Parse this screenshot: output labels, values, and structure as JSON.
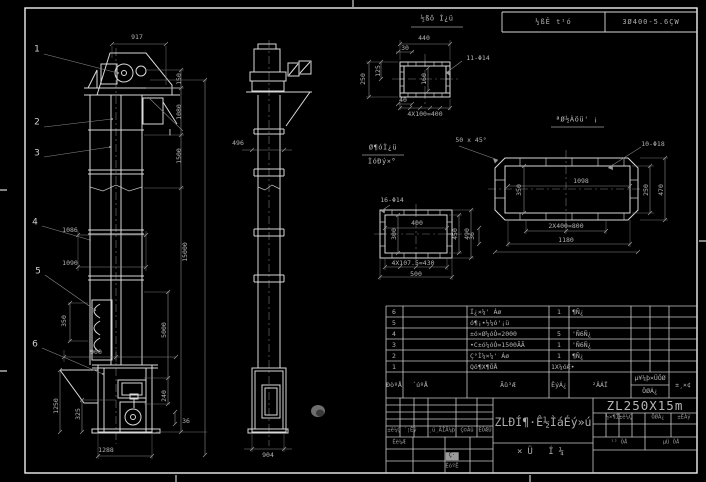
{
  "sheet": {
    "header_strip": {
      "left": "½ßÊ t¹ó",
      "right": "3Ø400-5.6ÇW"
    }
  },
  "annotations": [
    {
      "t": "917",
      "x": 137,
      "y": 37
    },
    {
      "t": "150",
      "x": 179,
      "y": 79,
      "r": 1
    },
    {
      "t": "1080",
      "x": 179,
      "y": 112,
      "r": 1
    },
    {
      "t": "1500",
      "x": 179,
      "y": 156,
      "r": 1
    },
    {
      "t": "15000",
      "x": 185,
      "y": 252,
      "r": 1
    },
    {
      "t": "1086",
      "x": 70,
      "y": 230
    },
    {
      "t": "1090",
      "x": 70,
      "y": 263
    },
    {
      "t": "350",
      "x": 64,
      "y": 321,
      "r": 1
    },
    {
      "t": "900",
      "x": 96,
      "y": 352
    },
    {
      "t": "5000",
      "x": 164,
      "y": 330,
      "r": 1
    },
    {
      "t": "240",
      "x": 164,
      "y": 396,
      "r": 1
    },
    {
      "t": "36",
      "x": 186,
      "y": 421
    },
    {
      "t": "1250",
      "x": 56,
      "y": 406,
      "r": 1
    },
    {
      "t": "325",
      "x": 78,
      "y": 414,
      "r": 1
    },
    {
      "t": "1288",
      "x": 106,
      "y": 450
    },
    {
      "t": "904",
      "x": 268,
      "y": 455
    },
    {
      "t": "496",
      "x": 238,
      "y": 143
    },
    {
      "t": "1",
      "x": 37,
      "y": 50,
      "c": "balloon"
    },
    {
      "t": "2",
      "x": 37,
      "y": 123,
      "c": "balloon"
    },
    {
      "t": "3",
      "x": 37,
      "y": 154,
      "c": "balloon"
    },
    {
      "t": "4",
      "x": 35,
      "y": 223,
      "c": "balloon"
    },
    {
      "t": "5",
      "x": 38,
      "y": 272,
      "c": "balloon"
    },
    {
      "t": "6",
      "x": 35,
      "y": 345,
      "c": "balloon"
    },
    {
      "t": "I",
      "x": 170,
      "y": 134,
      "c": "balloon"
    },
    {
      "t": "½ßô Ì¿ü",
      "x": 437,
      "y": 19,
      "c": "vt"
    },
    {
      "t": "440",
      "x": 424,
      "y": 38
    },
    {
      "t": "30",
      "x": 405,
      "y": 48
    },
    {
      "t": "250",
      "x": 363,
      "y": 79,
      "r": 1
    },
    {
      "t": "125",
      "x": 378,
      "y": 71,
      "r": 1
    },
    {
      "t": "160",
      "x": 424,
      "y": 79,
      "r": 1
    },
    {
      "t": "11-Φ14",
      "x": 478,
      "y": 58
    },
    {
      "t": "40",
      "x": 403,
      "y": 100
    },
    {
      "t": "4X100=400",
      "x": 425,
      "y": 114
    },
    {
      "t": "Ø¶óÌ¿ü",
      "x": 383,
      "y": 148,
      "c": "vt"
    },
    {
      "t": "ÌóÐý×°",
      "x": 382,
      "y": 162,
      "c": "vt"
    },
    {
      "t": "50 x 45°",
      "x": 471,
      "y": 140
    },
    {
      "t": "ªØ½Àöü' ¡",
      "x": 577,
      "y": 120,
      "c": "vt"
    },
    {
      "t": "10-Φ18",
      "x": 653,
      "y": 144
    },
    {
      "t": "1098",
      "x": 581,
      "y": 181
    },
    {
      "t": "350",
      "x": 519,
      "y": 190,
      "r": 1
    },
    {
      "t": "250",
      "x": 646,
      "y": 190,
      "r": 1
    },
    {
      "t": "470",
      "x": 661,
      "y": 190,
      "r": 1
    },
    {
      "t": "36",
      "x": 472,
      "y": 236,
      "r": 1
    },
    {
      "t": "2X400=800",
      "x": 566,
      "y": 226
    },
    {
      "t": "1180",
      "x": 566,
      "y": 240
    },
    {
      "t": "16-Φ14",
      "x": 392,
      "y": 200
    },
    {
      "t": "400",
      "x": 417,
      "y": 223
    },
    {
      "t": "300",
      "x": 394,
      "y": 234,
      "r": 1
    },
    {
      "t": "450",
      "x": 455,
      "y": 234,
      "r": 1
    },
    {
      "t": "490",
      "x": 467,
      "y": 234,
      "r": 1
    },
    {
      "t": "4X107.5=430",
      "x": 413,
      "y": 263
    },
    {
      "t": "500",
      "x": 416,
      "y": 274
    },
    {
      "t": "±ê¼Ç",
      "x": 394,
      "y": 431,
      "c": "tiny"
    },
    {
      "t": "´¦Êý",
      "x": 410,
      "y": 431,
      "c": "tiny"
    },
    {
      "t": "¸ü¸ÄÎÄ¼þ",
      "x": 442,
      "y": 431,
      "c": "tiny"
    },
    {
      "t": "Ç©Ãû",
      "x": 467,
      "y": 431,
      "c": "tiny"
    },
    {
      "t": "ÈÕÆÚ",
      "x": 485,
      "y": 431,
      "c": "tiny"
    },
    {
      "t": "Éè¼Æ",
      "x": 399,
      "y": 443,
      "c": "tiny"
    },
    {
      "t": "Ç·",
      "x": 452,
      "y": 456,
      "c": "hl"
    },
    {
      "t": "ÉóºË",
      "x": 452,
      "y": 467,
      "c": "tiny"
    },
    {
      "t": "½×¶Î±ê¼Ç",
      "x": 619,
      "y": 418,
      "c": "tiny"
    },
    {
      "t": "ÖØÁ¿",
      "x": 658,
      "y": 418,
      "c": "tiny"
    },
    {
      "t": "±ÈÀý",
      "x": 684,
      "y": 418,
      "c": "tiny"
    },
    {
      "t": "¹² ÕÅ",
      "x": 619,
      "y": 443,
      "c": "tiny"
    },
    {
      "t": "µÚ ÕÅ",
      "x": 671,
      "y": 443,
      "c": "tiny"
    }
  ],
  "bom": {
    "top": 306,
    "row_h": 11,
    "headers": [
      {
        "t": "ÐòºÅ",
        "x": 394
      },
      {
        "t": "´úºÅ",
        "x": 420
      },
      {
        "t": "Ãû³Æ",
        "x": 508
      },
      {
        "t": "ÊýÁ¿",
        "x": 559
      },
      {
        "t": "²ÄÁÏ",
        "x": 600
      },
      {
        "t": "µ¥¼þ×ÜÖØ",
        "x": 650,
        "y": 378
      },
      {
        "t": "ÖØÁ¿",
        "x": 650,
        "y": 391
      },
      {
        "t": "±¸×¢",
        "x": 683
      }
    ],
    "rows": [
      {
        "no": "6",
        "name": "Í¿×¼' Áø",
        "qty": "1",
        "mat": "¶Ñ¿"
      },
      {
        "no": "5",
        "name": "ó¶¡•½¼ó'¡ü",
        "qty": "",
        "mat": ""
      },
      {
        "no": "4",
        "name": "±ó×Ø¼óÒ=2000",
        "qty": "5",
        "mat": "'Ñ6Ñ¿"
      },
      {
        "no": "3",
        "name": "•C±ó¼óÒ=1500ÃÃ",
        "qty": "1",
        "mat": "'Ñ6Ñ¿"
      },
      {
        "no": "2",
        "name": "Ç°Ì¼×¼' Áø",
        "qty": "1",
        "mat": "¶Ñ¿"
      },
      {
        "no": "1",
        "name": "Qö¶X¶ÖÅ",
        "qty": "1X¼óÆ•",
        "mat": ""
      }
    ]
  },
  "title_block": {
    "model": "ZL250X15m",
    "title": "ZLÐÍ¶·Ê½ÌáÉý»ú",
    "subtitle": "×Ü Í¼"
  }
}
